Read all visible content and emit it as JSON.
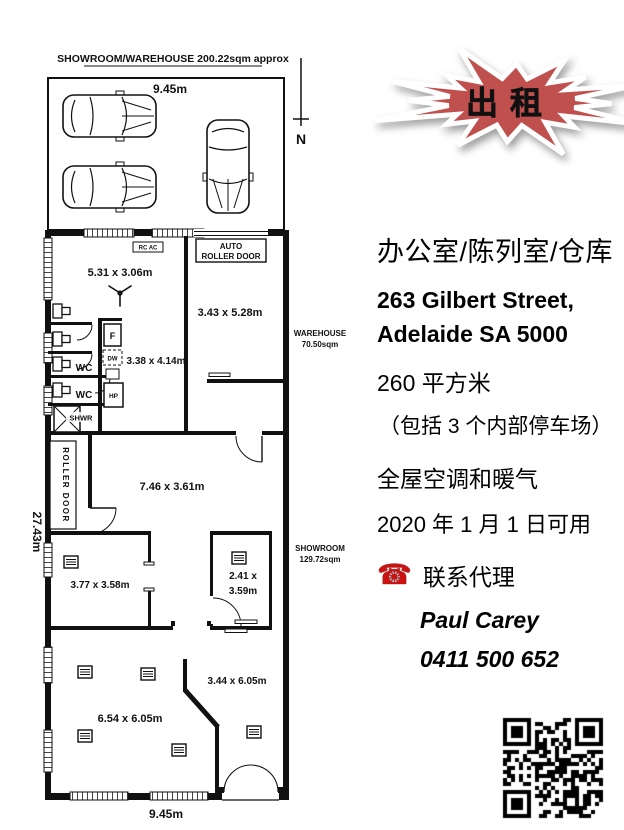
{
  "floorplan": {
    "title": "SHOWROOM/WAREHOUSE 200.22sqm approx",
    "north": "N",
    "dim_top": "9.45m",
    "dim_bottom": "9.45m",
    "dim_left": "27.43m",
    "labels": {
      "rc_ac": "RC AC",
      "auto_roller_1": "AUTO",
      "auto_roller_2": "ROLLER DOOR",
      "roller_door": "ROLLER DOOR",
      "warehouse_name": "WAREHOUSE",
      "warehouse_area": "70.50sqm",
      "showroom_name": "SHOWROOM",
      "showroom_area": "129.72sqm",
      "wc_1": "WC",
      "wc_2": "WC",
      "shower": "SHWR",
      "fridge": "F",
      "dishwasher": "DW",
      "hotplate": "HP"
    },
    "rooms": {
      "office": "5.31 x 3.06m",
      "warehouse": "3.43 x 5.28m",
      "kitchen": "3.38 x 4.14m",
      "middle": "7.46 x 3.61m",
      "small_left": "3.77 x 3.58m",
      "small_right_1": "2.41 x",
      "small_right_2": "3.59m",
      "bottom_right": "3.44 x 6.05m",
      "bottom_left": "6.54 x 6.05m"
    }
  },
  "listing": {
    "banner": "出租",
    "heading": "办公室/陈列室/仓库",
    "address_line1": "263 Gilbert Street,",
    "address_line2": "Adelaide SA 5000",
    "area": "260 平方米",
    "parking": "（包括 3 个内部停车场）",
    "climate": "全屋空调和暖气",
    "available": "2020 年 1 月 1 日可用",
    "contact_label": "联系代理",
    "agent_name": "Paul Carey",
    "agent_phone": "0411 500 652"
  },
  "icons": {
    "phone": "☎"
  },
  "colors": {
    "banner_fill": "#c0504d",
    "banner_text": "#3a3a3a",
    "phone_icon": "#cc1111",
    "line": "#111111"
  }
}
